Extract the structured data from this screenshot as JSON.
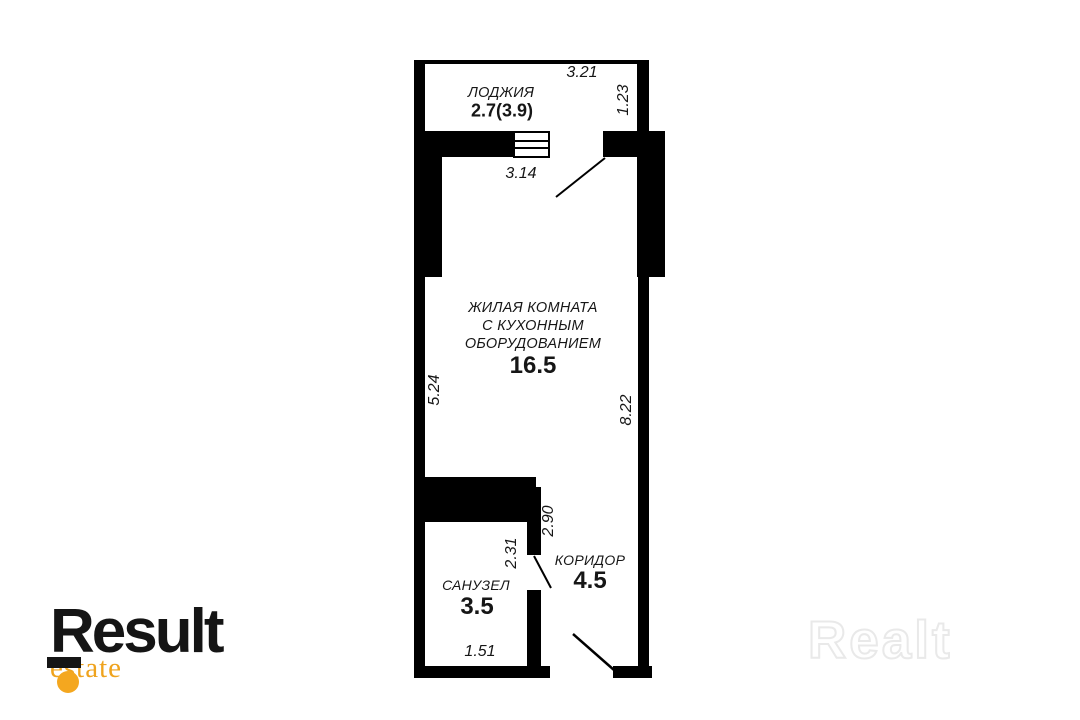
{
  "plan": {
    "rooms": {
      "loggia": {
        "name": "ЛОДЖИЯ",
        "area": "2.7(3.9)"
      },
      "living": {
        "name_lines": [
          "ЖИЛАЯ КОМНАТА",
          "С КУХОННЫМ",
          "ОБОРУДОВАНИЕМ"
        ],
        "area": "16.5"
      },
      "corridor": {
        "name": "КОРИДОР",
        "area": "4.5"
      },
      "bathroom": {
        "name": "САНУЗЕЛ",
        "area": "3.5"
      }
    },
    "dimensions": {
      "loggia_width": "3.21",
      "loggia_depth": "1.23",
      "window_width": "3.14",
      "room_width": "5.24",
      "room_height": "8.22",
      "corridor_height": "2.90",
      "bathroom_height": "2.31",
      "bathroom_width": "1.51"
    },
    "wall_color": "#000000",
    "text_color": "#161616"
  },
  "branding": {
    "logo_text": "Result",
    "logo_sub": "estate",
    "logo_black": "#151515",
    "accent_orange": "#F4A71F",
    "estate_orange": "#EFA31D",
    "watermark_text": "Realt",
    "watermark_gray": "#E9E9E9"
  }
}
